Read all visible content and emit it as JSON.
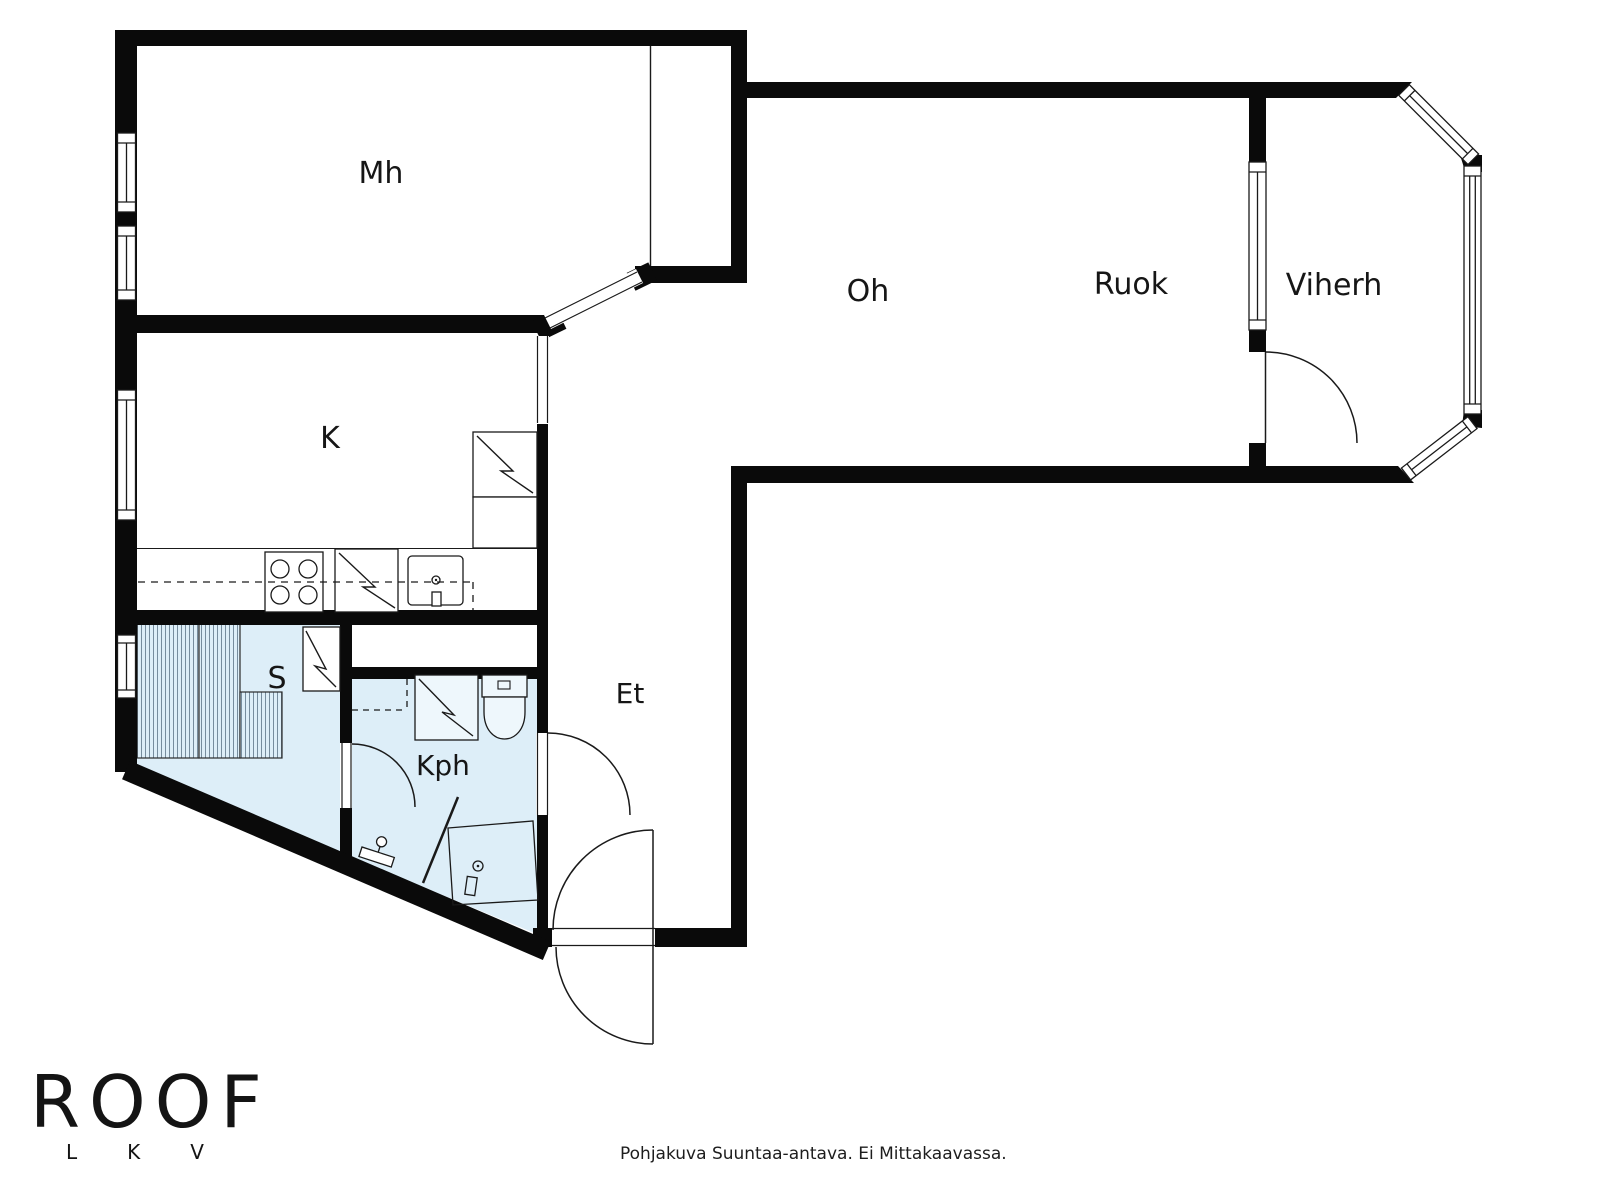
{
  "rooms": [
    {
      "key": "bedroom",
      "label": "Mh"
    },
    {
      "key": "kitchen",
      "label": "K"
    },
    {
      "key": "living-room",
      "label": "Oh"
    },
    {
      "key": "dining-room",
      "label": "Ruok"
    },
    {
      "key": "conservatory",
      "label": "Viherh"
    },
    {
      "key": "sauna",
      "label": "S"
    },
    {
      "key": "bathroom",
      "label": "Kph"
    },
    {
      "key": "entry-hall",
      "label": "Et"
    }
  ],
  "branding": {
    "name": "ROOF",
    "sub": "LKV"
  },
  "footer": {
    "disclaimer": "Pohjakuva Suuntaa-antava. Ei Mittakaavassa."
  },
  "colors": {
    "wall": "#0a0a0a",
    "wet_room_floor": "#ddeef8",
    "hatch_line": "#6b8193",
    "line": "#1a1a1a"
  }
}
